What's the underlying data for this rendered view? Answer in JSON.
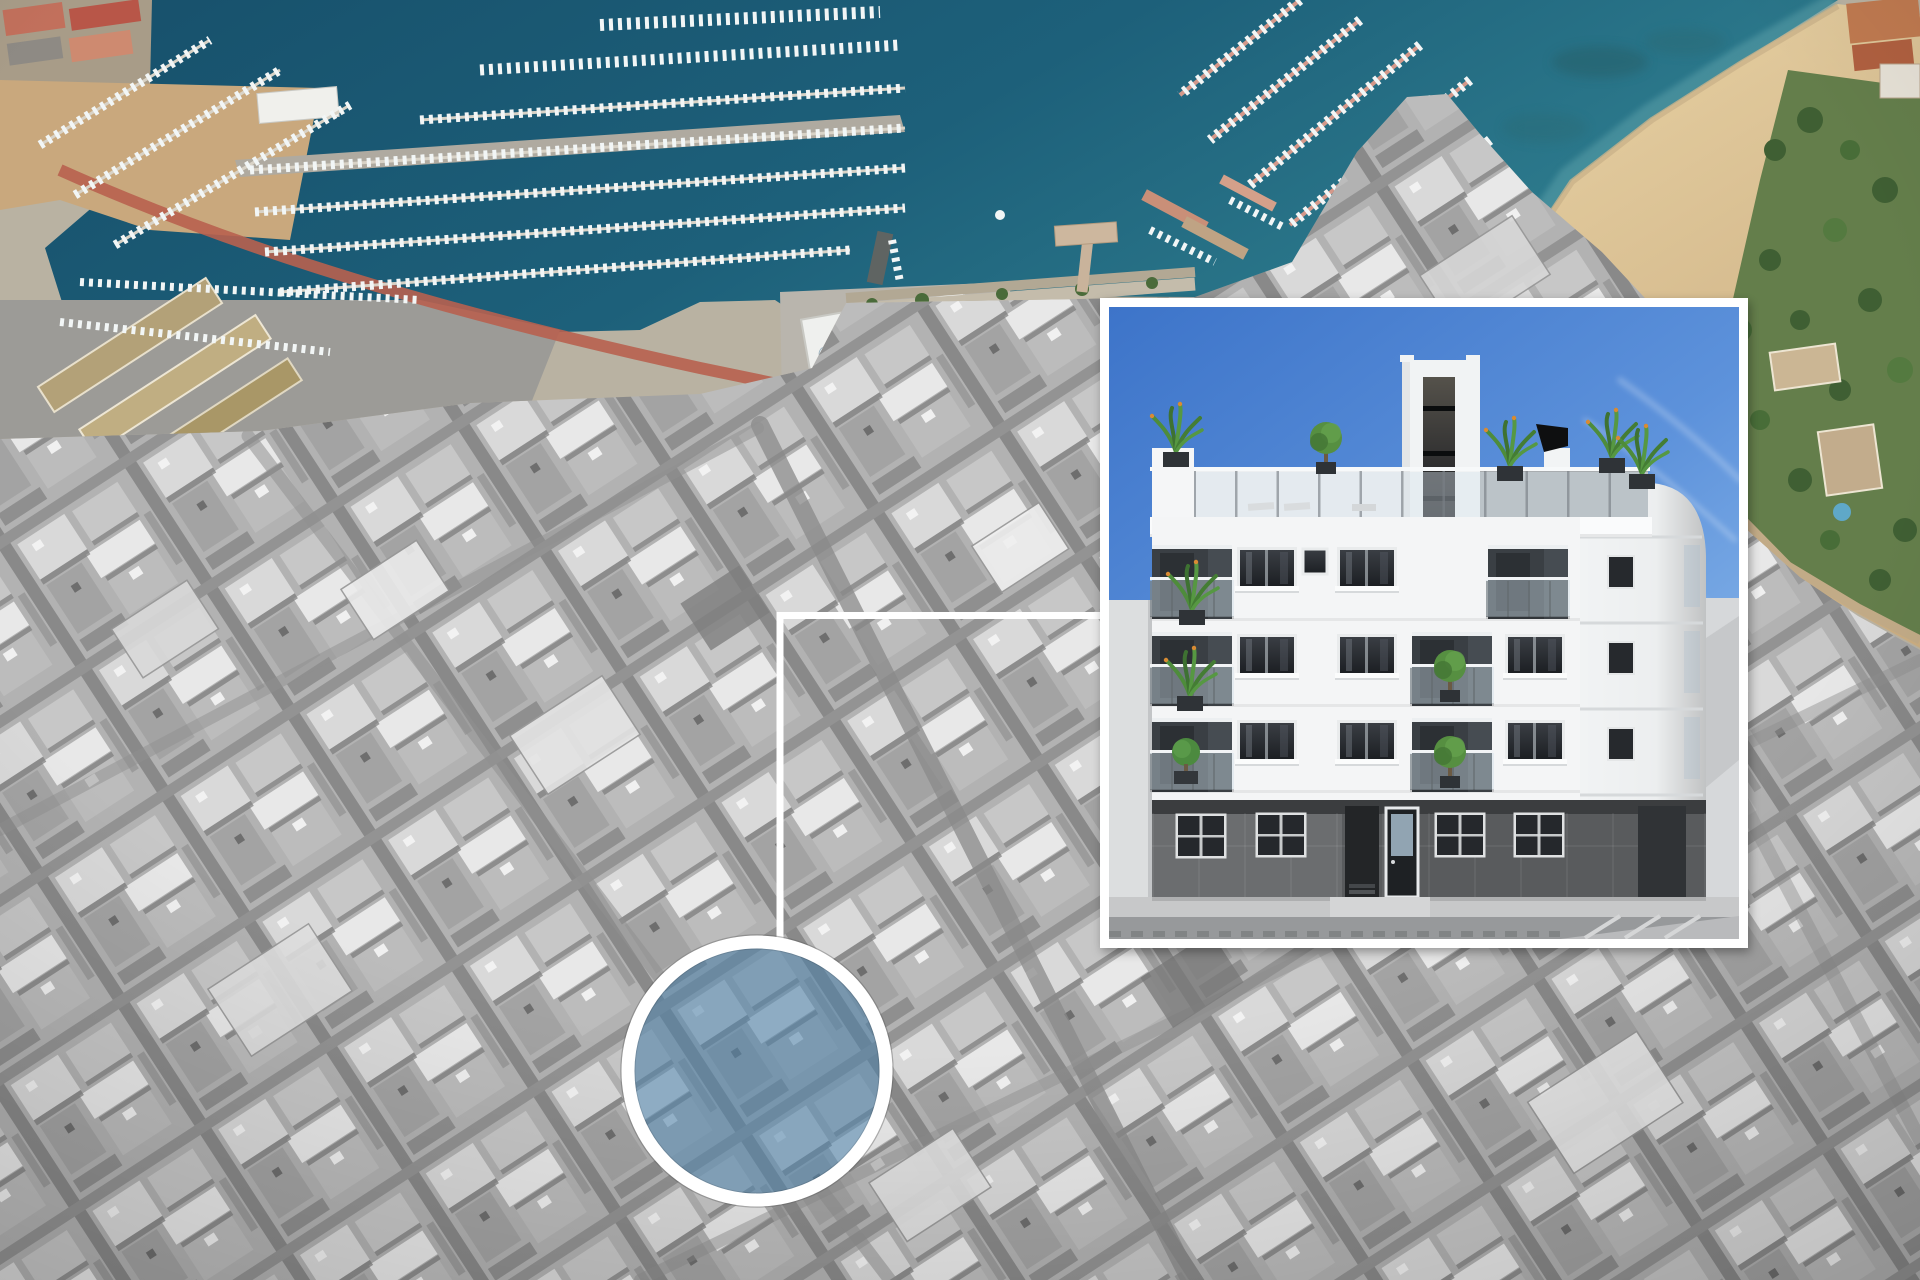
{
  "scene": {
    "title": "Aerial coastal city view with highlighted development site",
    "style": "satellite photo composite: colored marina waterfront over grayscale city",
    "elements": [
      "colored marina and beach waterfront strip",
      "grayscale dense city with diagonal street grid",
      "blue tinted circular site marker with white ring",
      "white zoom connector lines",
      "white framed architectural render of new apartment building"
    ]
  },
  "palette": {
    "city_base": "#B2B2B2",
    "water_deep": "#17506B",
    "water_light": "#2F7E8F",
    "sand_light": "#E8D2A4",
    "sand_dark": "#CBAE82",
    "park_green": "#647E4B",
    "pier_pink": "#D4988A",
    "red_road": "#B8604F",
    "marker_tint": "#4E82A8",
    "marker_ring": "#FFFFFF",
    "connector": "#FFFFFF",
    "inset_frame": "#FFFFFF",
    "sky_top": "#3D74C9",
    "sky_bottom": "#8FBCEC",
    "facade_white": "#F4F5F6",
    "ground_floor": "#595B5D",
    "window_glass": "#25282C",
    "vegetation": "#4C7D3C",
    "sidewalk": "#C7C8C9",
    "road": "#97999B"
  },
  "map": {
    "regions": [
      {
        "name": "marina-harbor",
        "description": "teal harbor water with rows of moored white boats along piers"
      },
      {
        "name": "fishing-port",
        "description": "western basin with tan warehouses, dirt lots, red coastal road"
      },
      {
        "name": "seawall",
        "description": "stone seawall with T-shaped pier in front of old town"
      },
      {
        "name": "beach",
        "description": "sandy beach with shallow turquoise water, northeast corner"
      },
      {
        "name": "seaside-park",
        "description": "green park with trees and buildings beside the beach"
      },
      {
        "name": "city",
        "description": "dense grayscale city blocks, diagonal street grid"
      }
    ],
    "marker": {
      "shape": "circle",
      "purpose": "development site location",
      "fill_tint": "#4E82A8",
      "ring_color": "#FFFFFF"
    },
    "connector": {
      "color": "#FFFFFF",
      "segments": [
        "vertical line from site circle up to corner",
        "horizontal line from corner to render inset"
      ]
    }
  },
  "inset": {
    "purpose": "render of new-build apartment block",
    "frame_color": "#FFFFFF",
    "sky": {
      "top": "#3D74C9",
      "bottom": "#8FBCEC",
      "clouds": "wispy diagonal streaks right side"
    },
    "building": {
      "floors_visible": 3,
      "facade_color": "#F4F5F6",
      "ground_floor_color": "#595B5D",
      "features": [
        "roof terrace with glass railing, loungers and plants",
        "central elevator tower with dark vertical glazing",
        "black angled chimney cowl",
        "rounded white corner tower with small windows",
        "recessed balconies with glass balustrades and planters",
        "dark framed windows with curtains",
        "gray stone ground floor with glazed entrance door",
        "light gray neighbouring walls, sidewalk and asphalt road"
      ]
    }
  }
}
